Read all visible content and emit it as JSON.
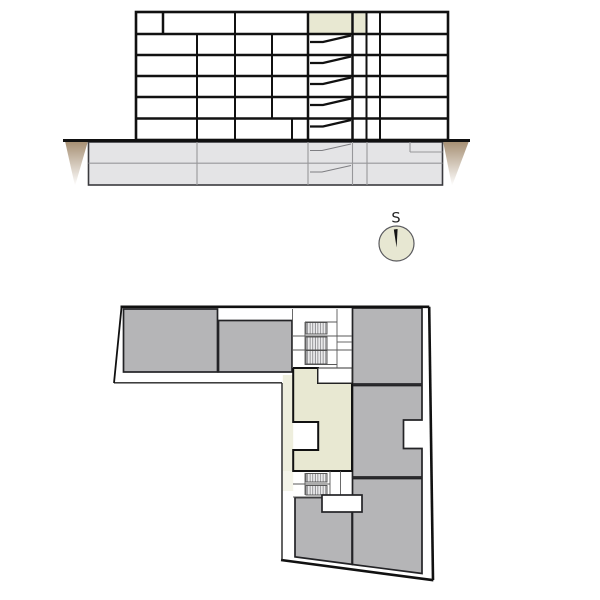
{
  "compass": {
    "label": "S"
  },
  "colors": {
    "line": "#111111",
    "highlight": "#e8e8d2",
    "highlight_soft": "#eeeedd",
    "highlight_faint": "#f4f4e9",
    "room_gray": "#b5b5b7",
    "basement_fill": "#e4e4e6",
    "basement_line": "#97979a",
    "earth": "#a0886a",
    "compass_fill": "#e7e7d2",
    "white": "#ffffff"
  },
  "section": {
    "floors_above_ground": 6,
    "basement_levels": 2,
    "highlighted_cells": 2
  },
  "plan": {
    "gray_rooms": 5,
    "stairwells": 2,
    "highlighted_unit": true
  }
}
